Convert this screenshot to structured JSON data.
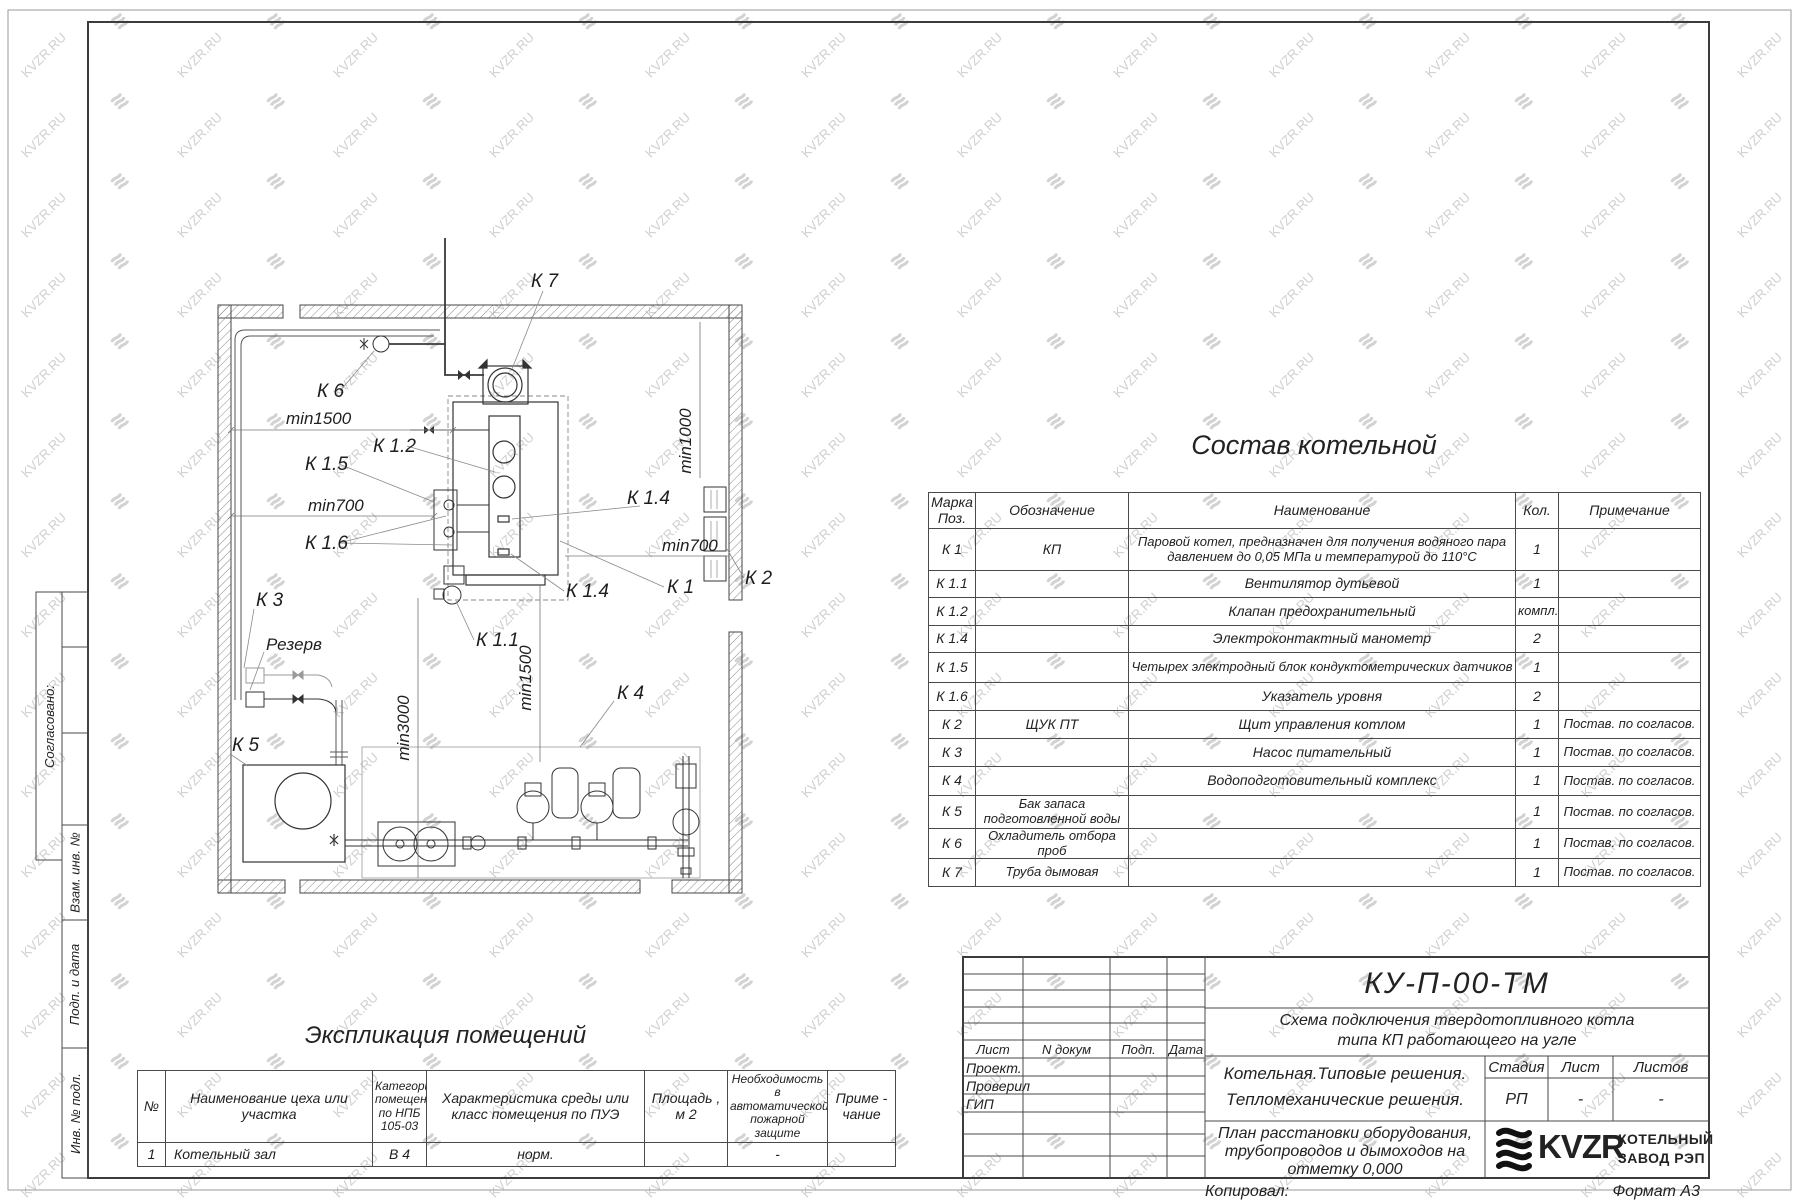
{
  "watermark": {
    "text": "KVZR.RU"
  },
  "sidebar": {
    "approved": "Согласовано:",
    "vzam": "Взам. инв. №",
    "podp": "Подп. и дата",
    "inv": "Инв. № подл."
  },
  "plan": {
    "labels": [
      "К 7",
      "К 6",
      "min1500",
      "К 1.2",
      "К 1.5",
      "min700",
      "К 1.6",
      "К 1.4",
      "min1000",
      "min700",
      "К 1",
      "К 2",
      "К 1.4",
      "К 1.1",
      "min1500",
      "min3000",
      "К 4",
      "К 3",
      "Резерв",
      "К 5"
    ]
  },
  "composition": {
    "title": "Состав котельной",
    "headers": [
      "Марка Поз.",
      "Обозначение",
      "Наименование",
      "Кол.",
      "Примечание"
    ],
    "rows": [
      {
        "mark": "К 1",
        "des": "КП",
        "name": "Паровой котел, предназначен для получения водяного пара давлением до 0,05 МПа и температурой до 110°С",
        "qty": "1",
        "note": ""
      },
      {
        "mark": "К 1.1",
        "des": "",
        "name": "Вентилятор дутьевой",
        "qty": "1",
        "note": ""
      },
      {
        "mark": "К 1.2",
        "des": "",
        "name": "Клапан предохранительный",
        "qty": "компл.",
        "note": ""
      },
      {
        "mark": "К 1.4",
        "des": "",
        "name": "Электроконтактный манометр",
        "qty": "2",
        "note": ""
      },
      {
        "mark": "К 1.5",
        "des": "",
        "name": "Четырех электродный блок кондуктометрических датчиков",
        "qty": "1",
        "note": ""
      },
      {
        "mark": "К 1.6",
        "des": "",
        "name": "Указатель уровня",
        "qty": "2",
        "note": ""
      },
      {
        "mark": "К 2",
        "des": "ЩУК ПТ",
        "name": "Щит управления котлом",
        "qty": "1",
        "note": "Постав. по согласов."
      },
      {
        "mark": "К 3",
        "des": "",
        "name": "Насос питательный",
        "qty": "1",
        "note": "Постав. по согласов."
      },
      {
        "mark": "К 4",
        "des": "",
        "name": "Водоподготовительный комплекс",
        "qty": "1",
        "note": "Постав. по согласов."
      },
      {
        "mark": "К 5",
        "des": "Бак запаса подготовленной воды",
        "name": "",
        "qty": "1",
        "note": "Постав. по согласов."
      },
      {
        "mark": "К 6",
        "des": "Охладитель отбора проб",
        "name": "",
        "qty": "1",
        "note": "Постав. по согласов."
      },
      {
        "mark": "К 7",
        "des": "Труба дымовая",
        "name": "",
        "qty": "1",
        "note": "Постав. по согласов."
      }
    ]
  },
  "explication": {
    "title": "Экспликация помещений",
    "headers": [
      "№",
      "Наименование цеха или участка",
      "Категория помещения по НПБ 105-03",
      "Характеристика среды или класс помещения по ПУЭ",
      "Площадь , м 2",
      "Необходимость в автоматической пожарной защите",
      "Приме - чание"
    ],
    "row": [
      "1",
      "Котельный зал",
      "В 4",
      "норм.",
      "",
      "-",
      ""
    ]
  },
  "titleblock": {
    "doc_number": "КУ-П-00-ТМ",
    "scheme_line1": "Схема подключения твердотопливного котла",
    "scheme_line2": "типа КП работающего на угле",
    "cols": [
      "Лист",
      "N докум",
      "Подп.",
      "Дата"
    ],
    "roles": [
      "Проект.",
      "Проверил",
      "ГИП"
    ],
    "object_line1": "Котельная.Типовые решения.",
    "object_line2": "Тепломеханические решения.",
    "stage_h": "Стадия",
    "sheet_h": "Лист",
    "sheets_h": "Листов",
    "stage": "РП",
    "sheet": "-",
    "sheets": "-",
    "plan_line1": "План расстановки оборудования,",
    "plan_line2": "трубопроводов и дымоходов на",
    "plan_line3": "отметку  0,000",
    "logo": "KVZR",
    "brand_line1": "КОТЕЛЬНЫЙ",
    "brand_line2": "ЗАВОД РЭП",
    "copied": "Копировал:",
    "format": "Формат А3"
  }
}
